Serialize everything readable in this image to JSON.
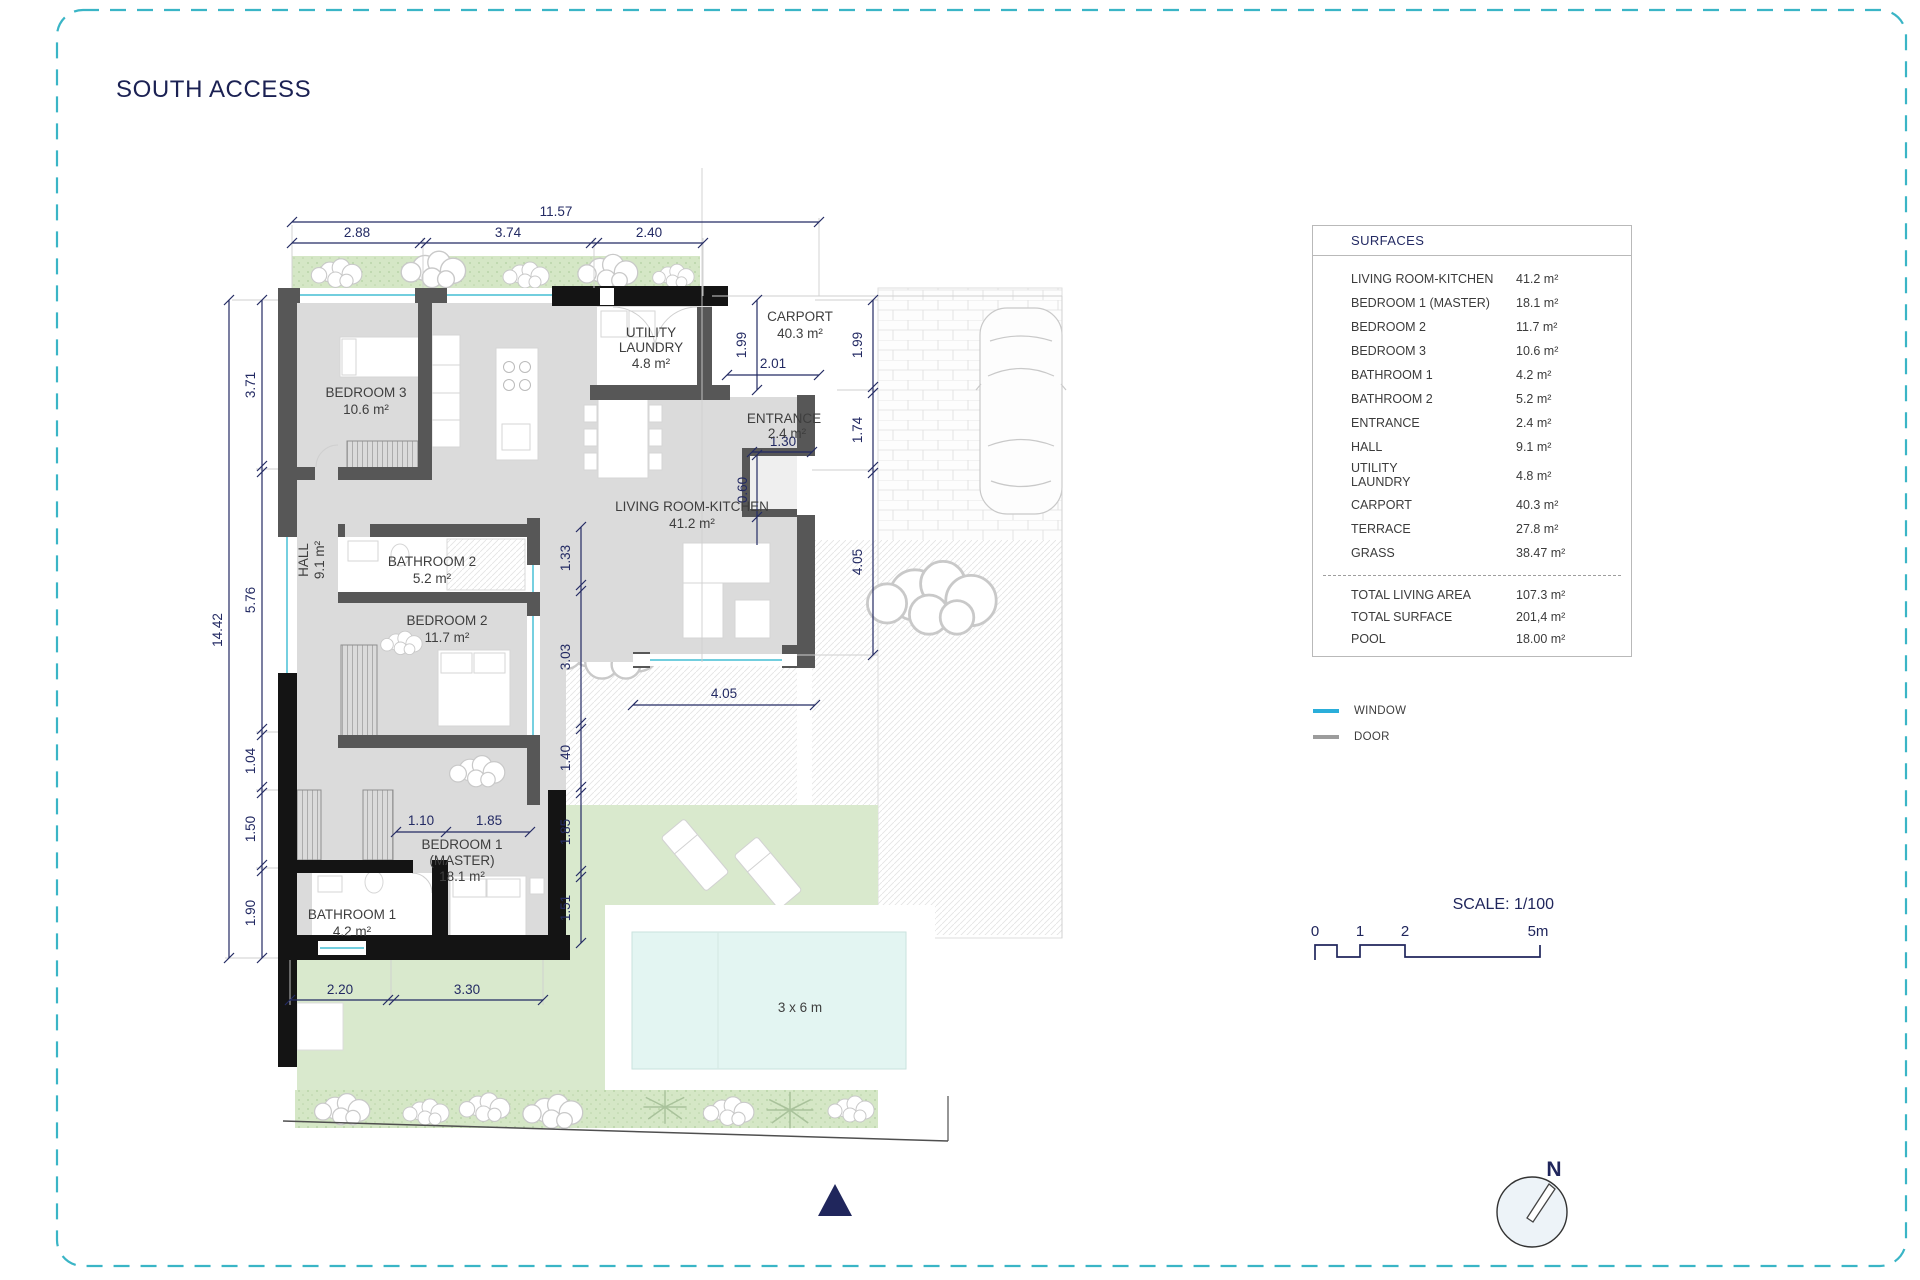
{
  "page": {
    "title": "SOUTH ACCESS"
  },
  "plan": {
    "labels": {
      "bedroom3": [
        "BEDROOM 3",
        "10.6 m²"
      ],
      "utility": [
        "UTILITY",
        "LAUNDRY",
        "4.8 m²"
      ],
      "carport": [
        "CARPORT",
        "40.3 m²"
      ],
      "entrance": [
        "ENTRANCE",
        "2.4 m²"
      ],
      "living": [
        "LIVING ROOM-KITCHEN",
        "41.2 m²"
      ],
      "hall": [
        "HALL",
        "9.1 m²"
      ],
      "bathroom2": [
        "BATHROOM 2",
        "5.2 m²"
      ],
      "bedroom2": [
        "BEDROOM 2",
        "11.7 m²"
      ],
      "bedroom1": [
        "BEDROOM 1",
        "(MASTER)",
        "18.1 m²"
      ],
      "bathroom1": [
        "BATHROOM 1",
        "4.2 m²"
      ]
    },
    "dims": {
      "topTotal": "11.57",
      "top0": "2.88",
      "top1": "3.74",
      "top2": "2.40",
      "leftTotal": "14.42",
      "left0": "3.71",
      "left1": "5.76",
      "left2": "1.04",
      "left3": "1.50",
      "left4": "1.90",
      "right0": "1.99",
      "right1": "1.74",
      "right2": "4.05",
      "carportH": "1.99",
      "carportW": "2.01",
      "entranceW": "1.30",
      "entranceD": "0.60",
      "mid0": "1.33",
      "mid1": "3.03",
      "mid2": "1.40",
      "mid3": "1.85",
      "mid4": "1.51",
      "terrace": "4.05",
      "master0": "1.10",
      "master1": "1.85",
      "bottom0": "2.20",
      "bottom1": "3.30",
      "pool": "3 x 6 m"
    }
  },
  "surfaces": {
    "title": "SURFACES",
    "rows": [
      {
        "label": "LIVING ROOM-KITCHEN",
        "value": "41.2 m²"
      },
      {
        "label": "BEDROOM 1 (MASTER)",
        "value": "18.1 m²"
      },
      {
        "label": "BEDROOM 2",
        "value": "11.7 m²"
      },
      {
        "label": "BEDROOM 3",
        "value": "10.6 m²"
      },
      {
        "label": "BATHROOM 1",
        "value": "4.2 m²"
      },
      {
        "label": "BATHROOM 2",
        "value": "5.2 m²"
      },
      {
        "label": "ENTRANCE",
        "value": "2.4 m²"
      },
      {
        "label": "HALL",
        "value": "9.1 m²"
      },
      {
        "label": "UTILITY LAUNDRY",
        "value": "4.8 m²"
      },
      {
        "label": "CARPORT",
        "value": "40.3 m²"
      },
      {
        "label": "TERRACE",
        "value": "27.8 m²"
      },
      {
        "label": "GRASS",
        "value": "38.47 m²"
      }
    ],
    "totals": [
      {
        "label": "TOTAL LIVING AREA",
        "value": "107.3 m²"
      },
      {
        "label": "TOTAL SURFACE",
        "value": "201,4 m²"
      },
      {
        "label": "POOL",
        "value": "18.00 m²"
      }
    ]
  },
  "legend": {
    "window": "WINDOW",
    "door": "DOOR"
  },
  "scale": {
    "title": "SCALE: 1/100",
    "ticks": [
      "0",
      "1",
      "2",
      "5m"
    ]
  },
  "compass": {
    "label": "N"
  },
  "colors": {
    "accent": "#3ab5c6",
    "window": "#2aaeda",
    "door": "#9c9c9c",
    "dim": "#232a63"
  }
}
